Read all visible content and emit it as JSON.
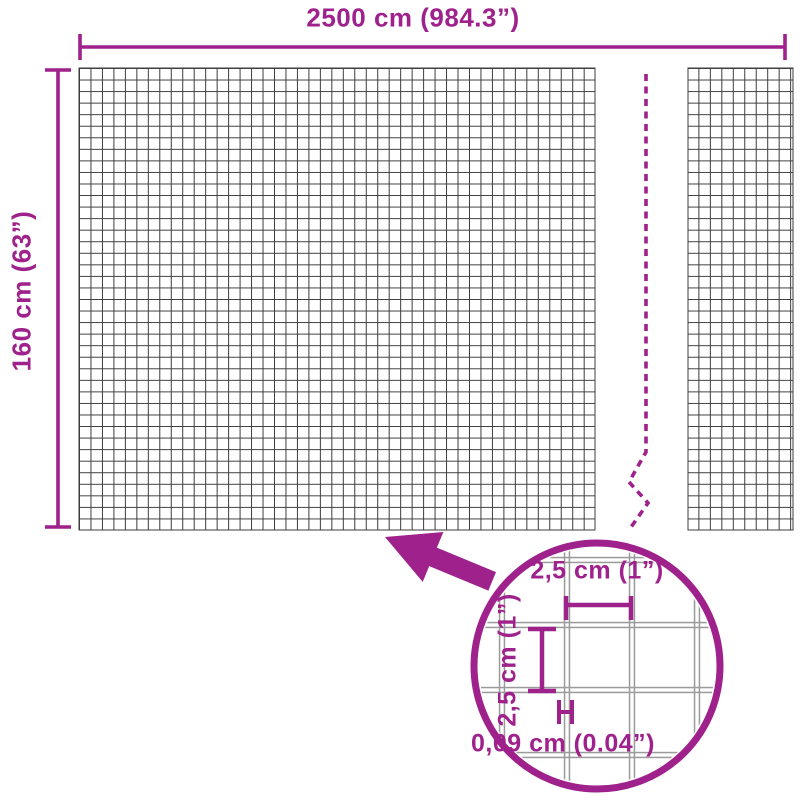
{
  "diagram": {
    "title": "wire-mesh-fence-dimension-diagram",
    "overall": {
      "width_label": "2500 cm (984.3”)",
      "height_label": "160 cm (63”)"
    },
    "detail": {
      "mesh_spacing_horizontal_label": "2,5 cm (1”)",
      "mesh_spacing_vertical_label": "2,5 cm (1”)",
      "wire_thickness_label": "0,09 cm (0.04”)"
    },
    "colors": {
      "accent_magenta": "#9E218C",
      "mesh_line_dark": "#3C3C3C",
      "detail_wire_gray": "#9A9A9A",
      "background": "#FFFFFF"
    }
  }
}
